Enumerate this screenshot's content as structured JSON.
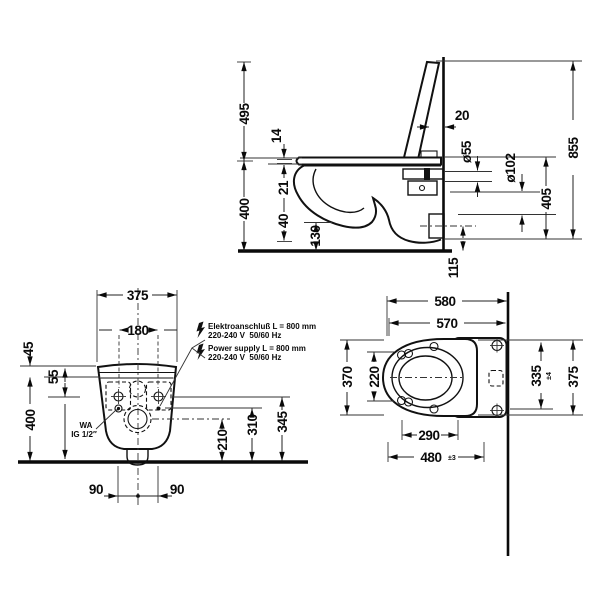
{
  "side": {
    "h495": "495",
    "h400": "400",
    "t14": "14",
    "t21": "21",
    "t40": "40",
    "t130": "130",
    "gap20": "20",
    "dia55": "ø55",
    "dia102": "ø102",
    "h405": "405",
    "h855": "855",
    "h115": "115"
  },
  "front": {
    "w375": "375",
    "w180": "180",
    "t45": "45",
    "t55": "55",
    "h400": "400",
    "b90l": "90",
    "b90r": "90",
    "h210": "210",
    "h310": "310",
    "h345": "345",
    "wa_line1": "WA",
    "wa_line2": "IG 1/2″",
    "de_line1": "Elektroanschluß L = 800 mm",
    "de_line2": "220-240 V  50/60 Hz",
    "en_line1": "Power supply L = 800 mm",
    "en_line2": "220-240 V  50/60 Hz"
  },
  "plan": {
    "d580": "580",
    "d570": "570",
    "d370": "370",
    "d220": "220",
    "d335": "335",
    "tol335": "±4",
    "d375": "375",
    "d290": "290",
    "d480": "480",
    "tol480": "±3"
  },
  "colors": {
    "line": "#111111",
    "background": "#ffffff"
  }
}
